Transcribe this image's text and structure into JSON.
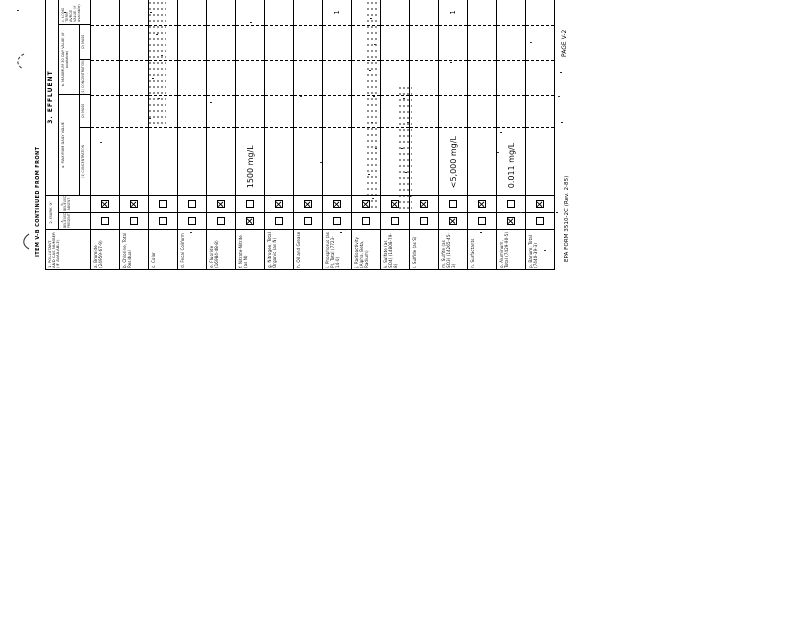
{
  "form": {
    "ink_color": "#111111",
    "paper_color": "#ffffff",
    "continued_label": "ITEM V-B CONTINUED FROM FRONT",
    "footer_form_number": "EPA FORM 3510-2C (Rev. 2-85)",
    "footer_page": "PAGE V-2",
    "headers": {
      "pollutant": "1. POLLUTANT AND CAS NUMBER (IF AVAILABLE)",
      "mark_x": "2. MARK 'X'",
      "believed_present": "a. BELIEVED PRESENT",
      "believed_absent": "b. BELIEVED ABSENT",
      "effluent": "3. EFFLUENT",
      "max_daily": "a. MAXIMUM DAILY VALUE",
      "max_30day": "b. MAXIMUM 30 DAY VALUE (if available)",
      "long_term": "c. LONG TERM AVRGE VALUE (if available)",
      "concentration": "(1) CONCENTRATION",
      "mass": "(2) MASS"
    },
    "rows": [
      {
        "label": "a. Bromide (24959-67-9)",
        "present": false,
        "absent": true,
        "max_daily": "",
        "long_term": ""
      },
      {
        "label": "b. Chlorine, Total Residual",
        "present": false,
        "absent": true,
        "max_daily": "",
        "long_term": ""
      },
      {
        "label": "c. Color",
        "present": false,
        "absent": false,
        "max_daily": "",
        "long_term": ""
      },
      {
        "label": "d. Fecal Coliform",
        "present": false,
        "absent": false,
        "max_daily": "",
        "long_term": ""
      },
      {
        "label": "e. Fluoride (16984-48-8)",
        "present": false,
        "absent": true,
        "max_daily": "",
        "long_term": ""
      },
      {
        "label": "f. Nitrate-Nitrite (as N)",
        "present": true,
        "absent": false,
        "max_daily": "1500 mg/L",
        "long_term": ""
      },
      {
        "label": "g. Nitrogen, Total Organic (as N)",
        "present": false,
        "absent": true,
        "max_daily": "",
        "long_term": ""
      },
      {
        "label": "h. Oil and Grease",
        "present": false,
        "absent": true,
        "max_daily": "",
        "long_term": ""
      },
      {
        "label": "i. Phosphorus (as P), Total (7723-14-0)",
        "present": false,
        "absent": true,
        "max_daily": "",
        "long_term": "1"
      },
      {
        "label": "j. Radioactivity (Alpha, Beta, Radium)",
        "present": false,
        "absent": true,
        "max_daily": "",
        "long_term": ""
      },
      {
        "label": "k. Sulfate (as SO4) (14808-79-8)",
        "present": false,
        "absent": true,
        "max_daily": "",
        "long_term": ""
      },
      {
        "label": "l. Sulfide (as S)",
        "present": false,
        "absent": true,
        "max_daily": "",
        "long_term": ""
      },
      {
        "label": "m. Sulfite (as SO3) (14265-45-3)",
        "present": true,
        "absent": false,
        "max_daily": "<5,000 mg/L",
        "long_term": "1"
      },
      {
        "label": "n. Surfactants",
        "present": false,
        "absent": true,
        "max_daily": "",
        "long_term": ""
      },
      {
        "label": "o. Aluminum, Total (7429-90-5)",
        "present": true,
        "absent": false,
        "max_daily": "0.011 mg/L",
        "long_term": ""
      },
      {
        "label": "p. Barium, Total (7440-39-3)",
        "present": false,
        "absent": true,
        "max_daily": "",
        "long_term": ""
      }
    ]
  }
}
